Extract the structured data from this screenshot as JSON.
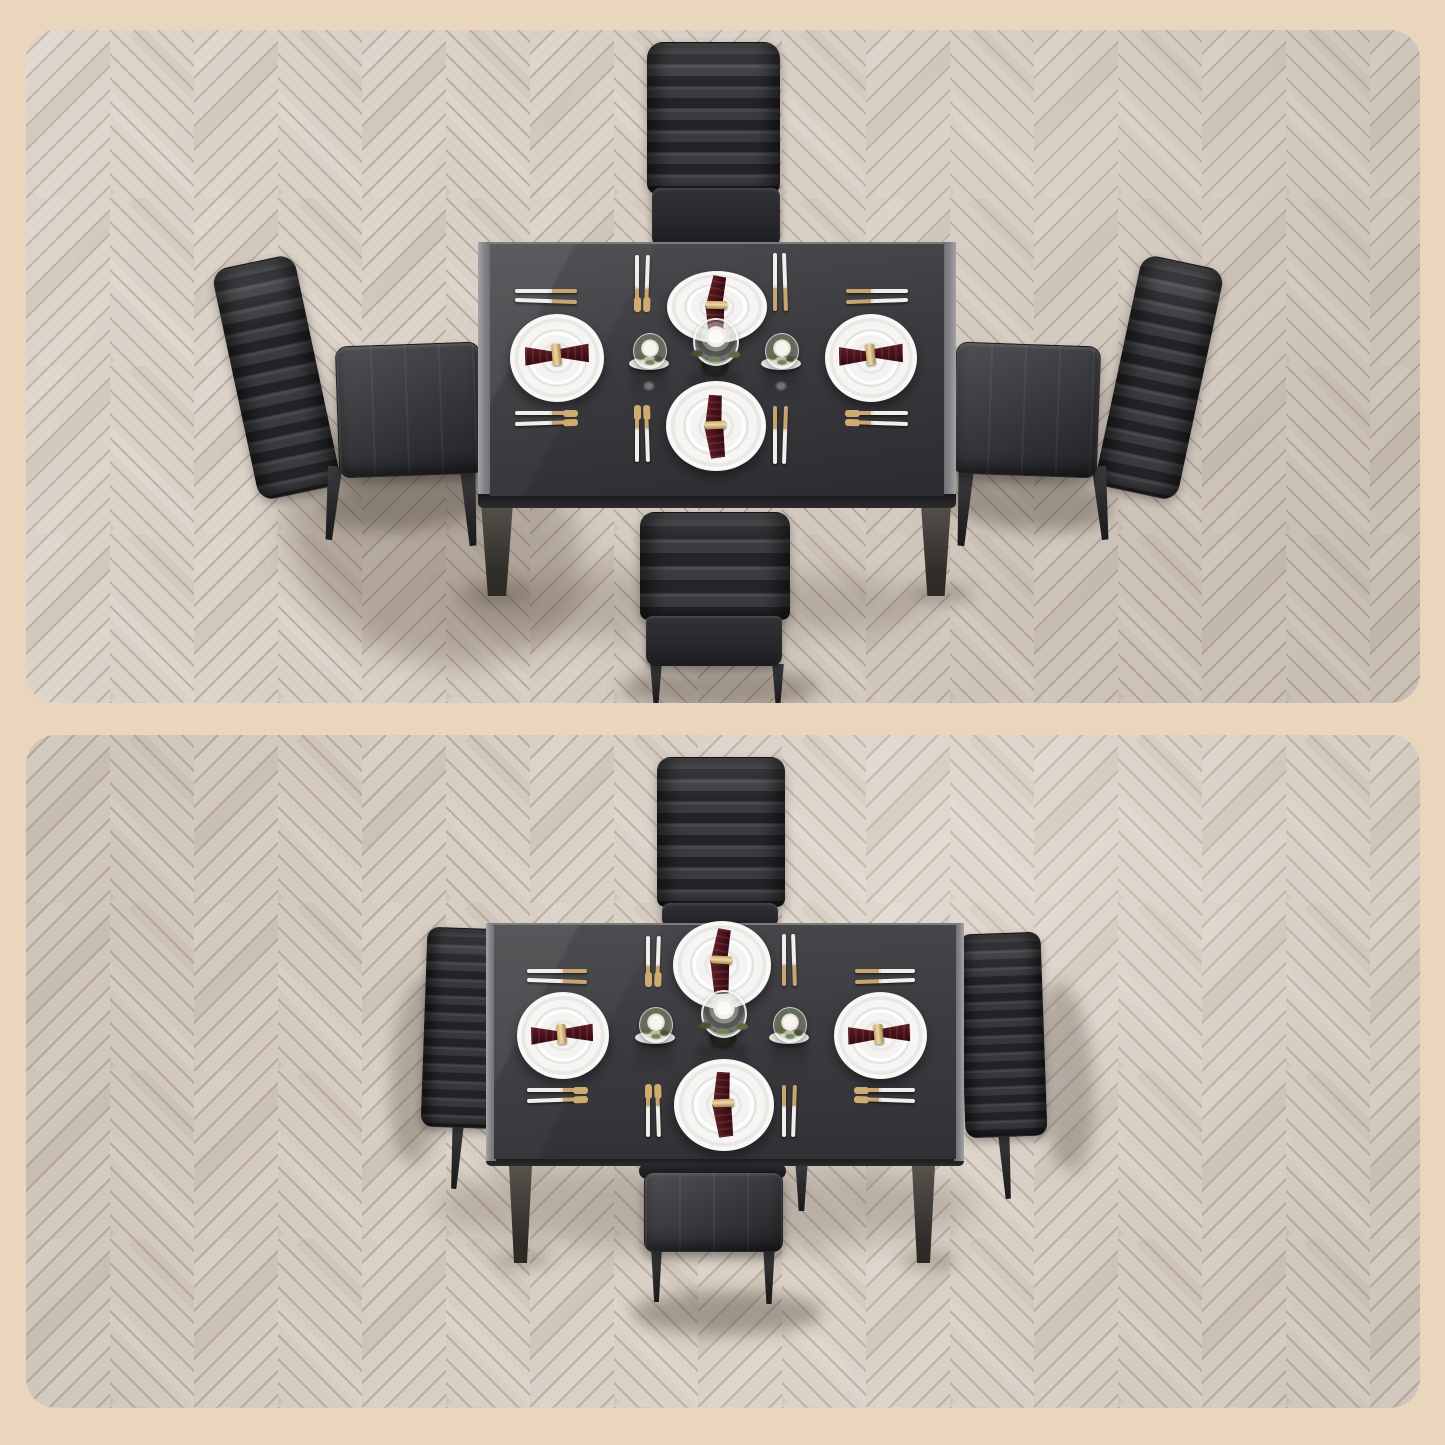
{
  "image": {
    "type": "furniture product photo",
    "subject": "5-piece black glass dining table set shown from above in two views",
    "alt": "Two top-down views of a rectangular black glass dining table with four black channel-tufted faux leather chairs on a light herringbone wood floor, set with four white plates, burgundy napkins, two-tone flatware and candle centerpieces"
  },
  "panels": [
    {
      "label": "Angled top view of dining set",
      "view": "angled-top",
      "chairs": 4,
      "place_settings": 4
    },
    {
      "label": "Straight overhead view of dining set",
      "view": "overhead",
      "chairs": 4,
      "place_settings": 4
    }
  ],
  "objects": {
    "table": {
      "top": "black tempered glass",
      "frame": "metal with silver side edges",
      "legs": 4
    },
    "chairs": {
      "count": 4,
      "upholstery": "black faux leather",
      "back_style": "horizontal channel tufting",
      "positions": [
        "north",
        "south",
        "east",
        "west"
      ]
    },
    "place_setting": {
      "plate": "round white plate on charger",
      "napkin": "dark burgundy bow fold with gold ring",
      "flatware": "silver handles with gold heads",
      "flatware_pieces_per_setting": 4
    },
    "centerpiece": {
      "hurricane_glass": 1,
      "votive_candles": 2,
      "candle_color": "white",
      "greenery": true,
      "white_coasters": 2
    }
  },
  "palette": {
    "backdrop": "#e9d6bd",
    "floor": "#d9d0c6",
    "floor_seam": "#b2a496",
    "glass_top": "#3c3c40",
    "chair": "#3a3a3e",
    "plate": "#f5f4f2",
    "napkin": "#471119",
    "gold": "#c9a670",
    "silver": "#eeede9",
    "greenery": "#5e6c45"
  }
}
